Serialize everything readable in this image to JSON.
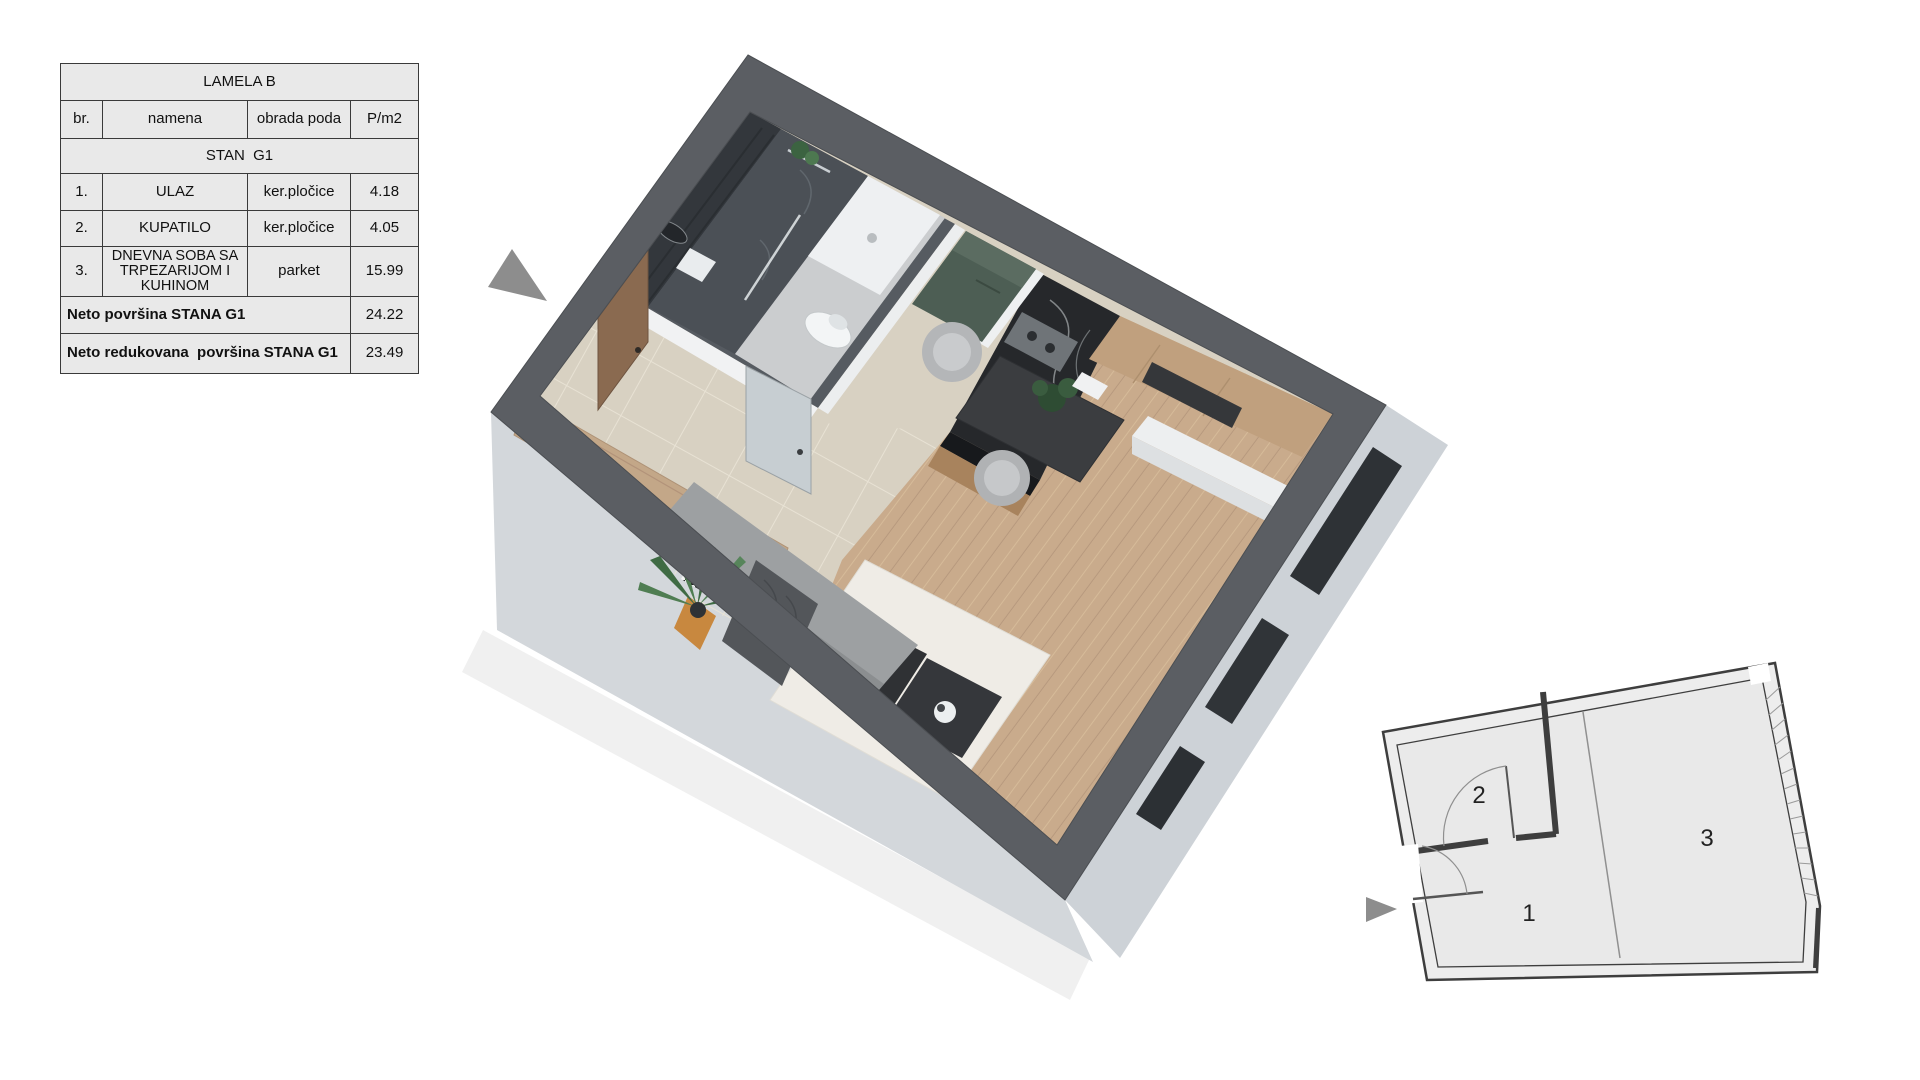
{
  "table": {
    "title": "LAMELA B",
    "columns": [
      "br.",
      "namena",
      "obrada poda",
      "P/m2"
    ],
    "section": "STAN  G1",
    "rows": [
      {
        "num": "1.",
        "name": "ULAZ",
        "floor": "ker.pločice",
        "area": "4.18"
      },
      {
        "num": "2.",
        "name": "KUPATILO",
        "floor": "ker.pločice",
        "area": "4.05"
      },
      {
        "num": "3.",
        "name": "DNEVNA SOBA SA TRPEZARIJOM  I KUHINOM",
        "floor": "parket",
        "area": "15.99"
      }
    ],
    "totals": [
      {
        "label": "Neto površina STANA G1",
        "value": "24.22"
      },
      {
        "label": "Neto redukovana  površina STANA G1",
        "value": "23.49"
      }
    ]
  },
  "mini_plan": {
    "room1": "1",
    "room2": "2",
    "room3": "3"
  },
  "colors": {
    "wall_top": "#5b5e63",
    "wall_face": "#d3d7db",
    "wall_face_right": "#cdd2d7",
    "floor_tile": "#d8d1c2",
    "floor_wood": "#c9ab8c",
    "rug": "#efece6",
    "sofa": "#9da0a2",
    "cabinet_green": "#4d5e54",
    "kitchen_marble": "#26282b",
    "wood_panel": "#c0a07e",
    "arrow": "#8d8d8d",
    "plan_fill": "#ededed",
    "plan_line": "#3e3e3e",
    "table_bg": "#e9e9e9",
    "table_border": "#3a3a3a"
  }
}
